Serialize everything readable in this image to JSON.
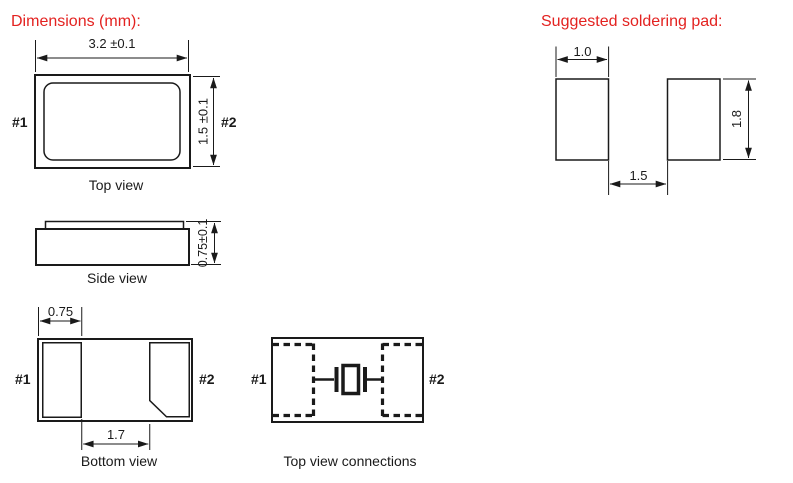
{
  "titles": {
    "dimensions": "Dimensions (mm):",
    "soldering": "Suggested soldering pad:"
  },
  "colors": {
    "accent_red": "#e32220",
    "line_black": "#1a1a1a",
    "background": "#ffffff"
  },
  "top_view": {
    "caption": "Top view",
    "width_dim": "3.2 ±0.1",
    "height_dim": "1.5 ±0.1",
    "pin1": "#1",
    "pin2": "#2"
  },
  "side_view": {
    "caption": "Side view",
    "thickness_dim": "0.75±0.1"
  },
  "bottom_view": {
    "caption": "Bottom view",
    "pad_width_dim": "0.75",
    "pad_gap_dim": "1.7",
    "pin1": "#1",
    "pin2": "#2"
  },
  "connections_view": {
    "caption": "Top view connections",
    "pin1": "#1",
    "pin2": "#2"
  },
  "soldering_pad": {
    "pad_width_dim": "1.0",
    "pad_gap_dim": "1.5",
    "pad_height_dim": "1.8"
  }
}
